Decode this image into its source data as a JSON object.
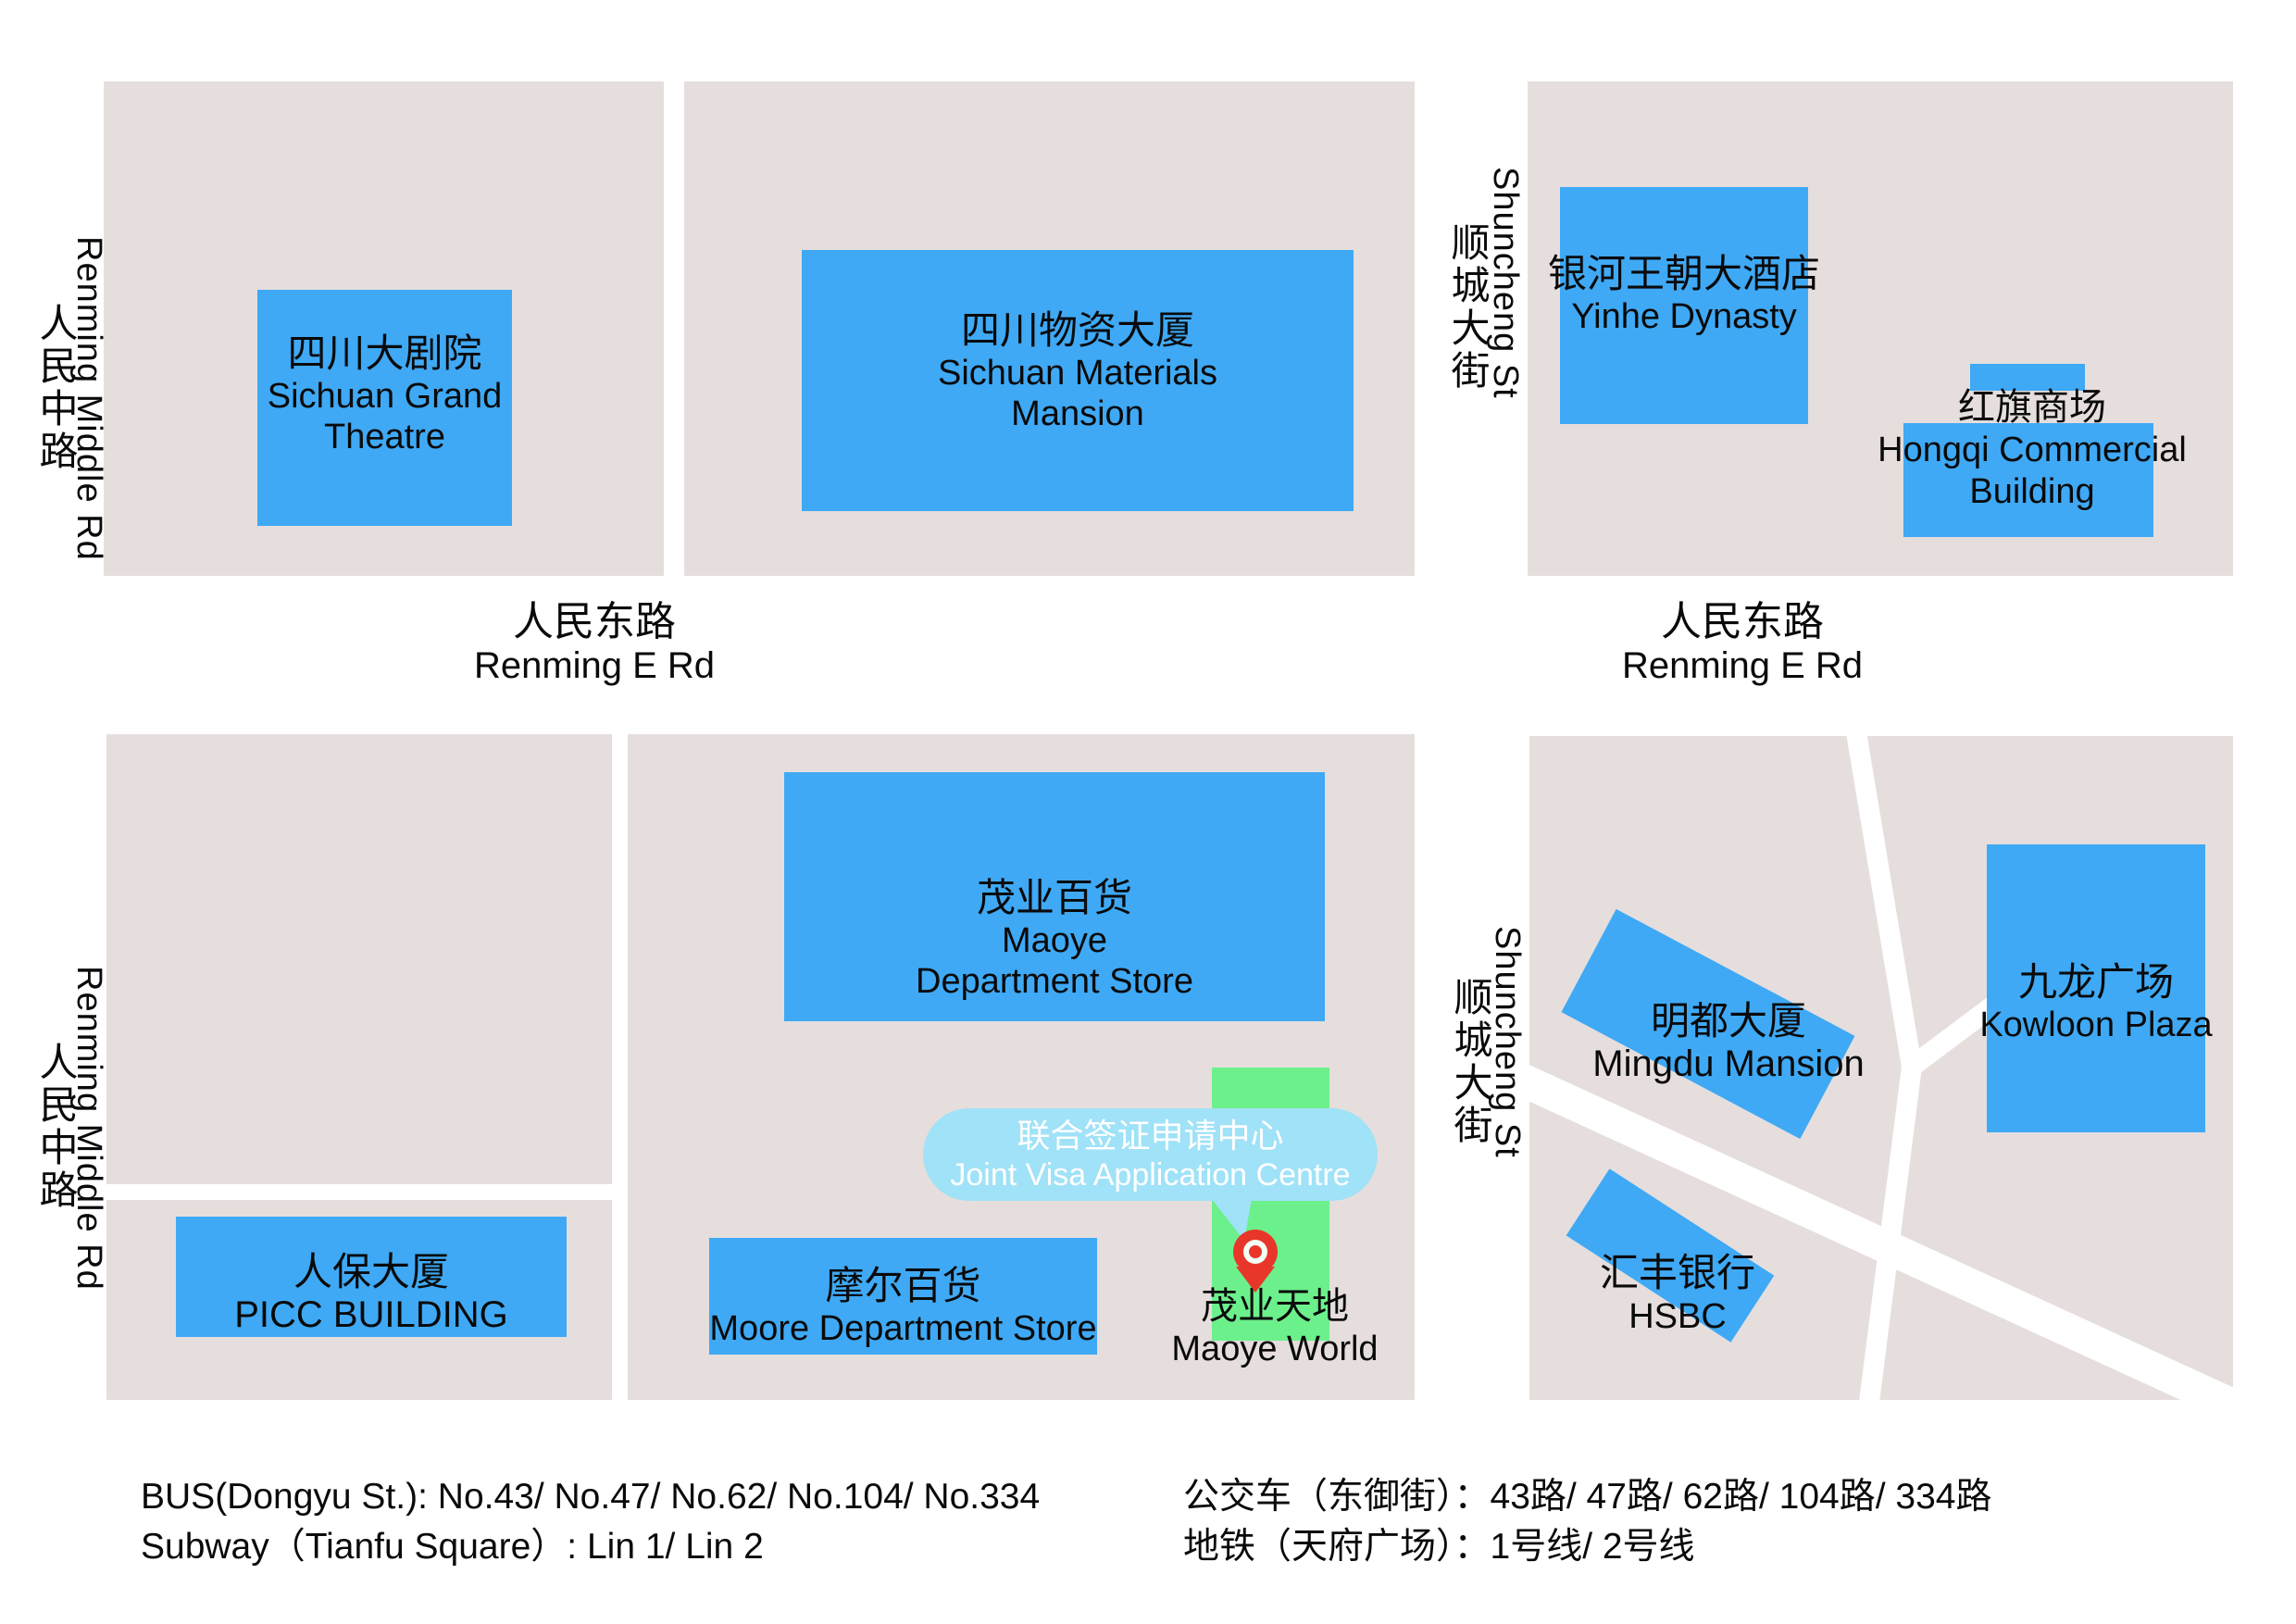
{
  "roads": {
    "renming_middle": {
      "zh": "人民中路",
      "en": "Renming Middle Rd"
    },
    "renming_e": {
      "zh": "人民东路",
      "en": "Renming E Rd"
    },
    "shuncheng": {
      "zh": "顺城大街",
      "en": "Shuncheng St"
    }
  },
  "buildings": {
    "theatre": {
      "lines": [
        "四川大剧院",
        "Sichuan Grand",
        "Theatre"
      ]
    },
    "materials": {
      "lines": [
        "四川物资大厦",
        "Sichuan Materials",
        "Mansion"
      ]
    },
    "yinhe": {
      "lines": [
        "银河王朝大酒店",
        "Yinhe Dynasty"
      ]
    },
    "hongqi": {
      "lines": [
        "红旗商场",
        "Hongqi Commercial",
        "Building"
      ]
    },
    "maoye_store": {
      "lines": [
        "茂业百货",
        "Maoye",
        "Department Store"
      ]
    },
    "picc": {
      "lines": [
        "人保大厦",
        "PICC BUILDING"
      ]
    },
    "moore": {
      "lines": [
        "摩尔百货",
        "Moore Department Store"
      ]
    },
    "mingdu": {
      "lines": [
        "明都大厦",
        "Mingdu Mansion"
      ]
    },
    "kowloon": {
      "lines": [
        "九龙广场",
        "Kowloon Plaza"
      ]
    },
    "hsbc": {
      "lines": [
        "汇丰银行",
        "HSBC"
      ]
    },
    "maoye_world": {
      "lines": [
        "茂业天地",
        "Maoye World"
      ]
    }
  },
  "marker": {
    "tooltip_zh": "联合签证申请中心",
    "tooltip_en": "Joint Visa Application Centre"
  },
  "info": {
    "bus_en": "BUS(Dongyu St.): No.43/ No.47/ No.62/ No.104/ No.334",
    "subway_en": "Subway（Tianfu Square）: Lin 1/ Lin 2",
    "bus_zh": "公交车（东御街）：43路/ 47路/ 62路/ 104路/ 334路",
    "subway_zh": "地铁（天府广场）：1号线/ 2号线"
  },
  "colors": {
    "building": "#3FA9F5",
    "block": "#E5DEDD",
    "highlight_green": "#6CF08C",
    "tooltip": "#A0E2F7",
    "pin_red": "#E8362B"
  }
}
